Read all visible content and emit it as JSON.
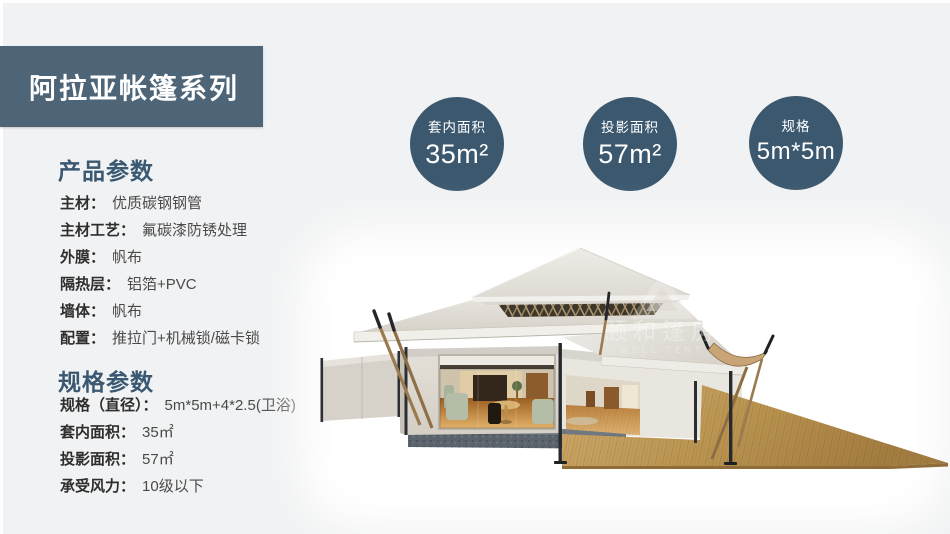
{
  "banner": {
    "title": "阿拉亚帐篷系列"
  },
  "product_params": {
    "heading": "产品参数",
    "items": [
      {
        "label": "主材：",
        "value": "优质碳钢钢管"
      },
      {
        "label": "主材工艺：",
        "value": "氟碳漆防锈处理"
      },
      {
        "label": "外膜：",
        "value": "帆布"
      },
      {
        "label": "隔热层：",
        "value": "铝箔+PVC"
      },
      {
        "label": "墙体：",
        "value": "帆布"
      },
      {
        "label": "配置：",
        "value": "推拉门+机械锁/磁卡锁"
      }
    ]
  },
  "spec_params": {
    "heading": "规格参数",
    "items": [
      {
        "label": "规格（直径）：",
        "value": "5m*5m+4*2.5(卫浴)"
      },
      {
        "label": "套内面积：",
        "value": "35㎡"
      },
      {
        "label": "投影面积：",
        "value": "57㎡"
      },
      {
        "label": "承受风力：",
        "value": "10级以下"
      }
    ]
  },
  "badges": {
    "items": [
      {
        "label": "套内面积",
        "value": "35m²"
      },
      {
        "label": "投影面积",
        "value": "57m²"
      },
      {
        "label": "规格",
        "value": "5m*5m"
      }
    ]
  },
  "watermark": {
    "cn": "颐和篷房",
    "en": "WELL TENT"
  },
  "colors": {
    "page_bg": "#f1f2f3",
    "banner_bg": "#4d6577",
    "badge_bg": "#3b586e",
    "heading_text": "#3a5871",
    "roof": "#ddd9d1",
    "wall": "#ded9d0",
    "deck_wood": "#bb9255",
    "stone_base": "#5b636c",
    "pole": "#2c3034",
    "strut_wood": "#9c7a50"
  }
}
